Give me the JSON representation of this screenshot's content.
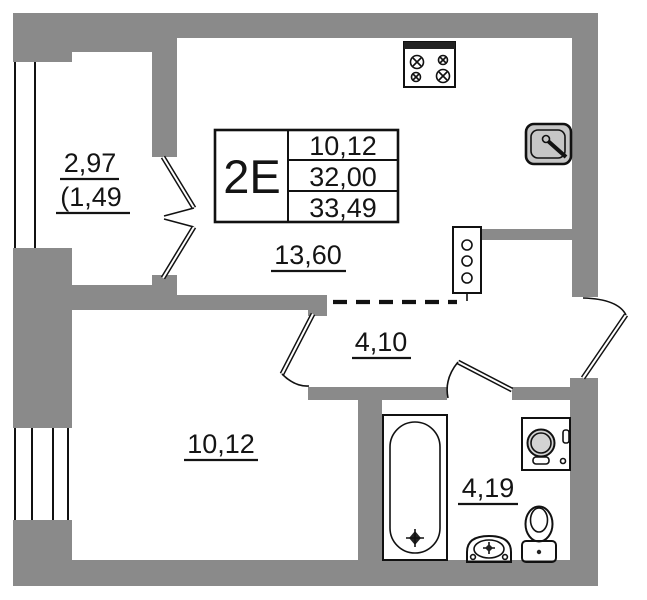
{
  "floor_plan": {
    "info_box": {
      "type_label": "2E",
      "values": [
        "10,12",
        "32,00",
        "33,49"
      ]
    },
    "areas": {
      "balcony": "2,97",
      "balcony_reduced": "(1,49",
      "kitchen_living": "13,60",
      "hallway": "4,10",
      "room": "10,12",
      "bathroom": "4,19"
    },
    "fixtures": [
      "stove",
      "kitchen-sink",
      "ventilation-shaft",
      "bathtub",
      "washing-machine",
      "toilet",
      "wash-basin"
    ],
    "colors": {
      "wall": "#8a8a8a",
      "fixture": "#c6c6c6",
      "fixture_light": "#d3d3d3",
      "line": "#111111",
      "text": "#141414",
      "background": "#ffffff"
    }
  }
}
